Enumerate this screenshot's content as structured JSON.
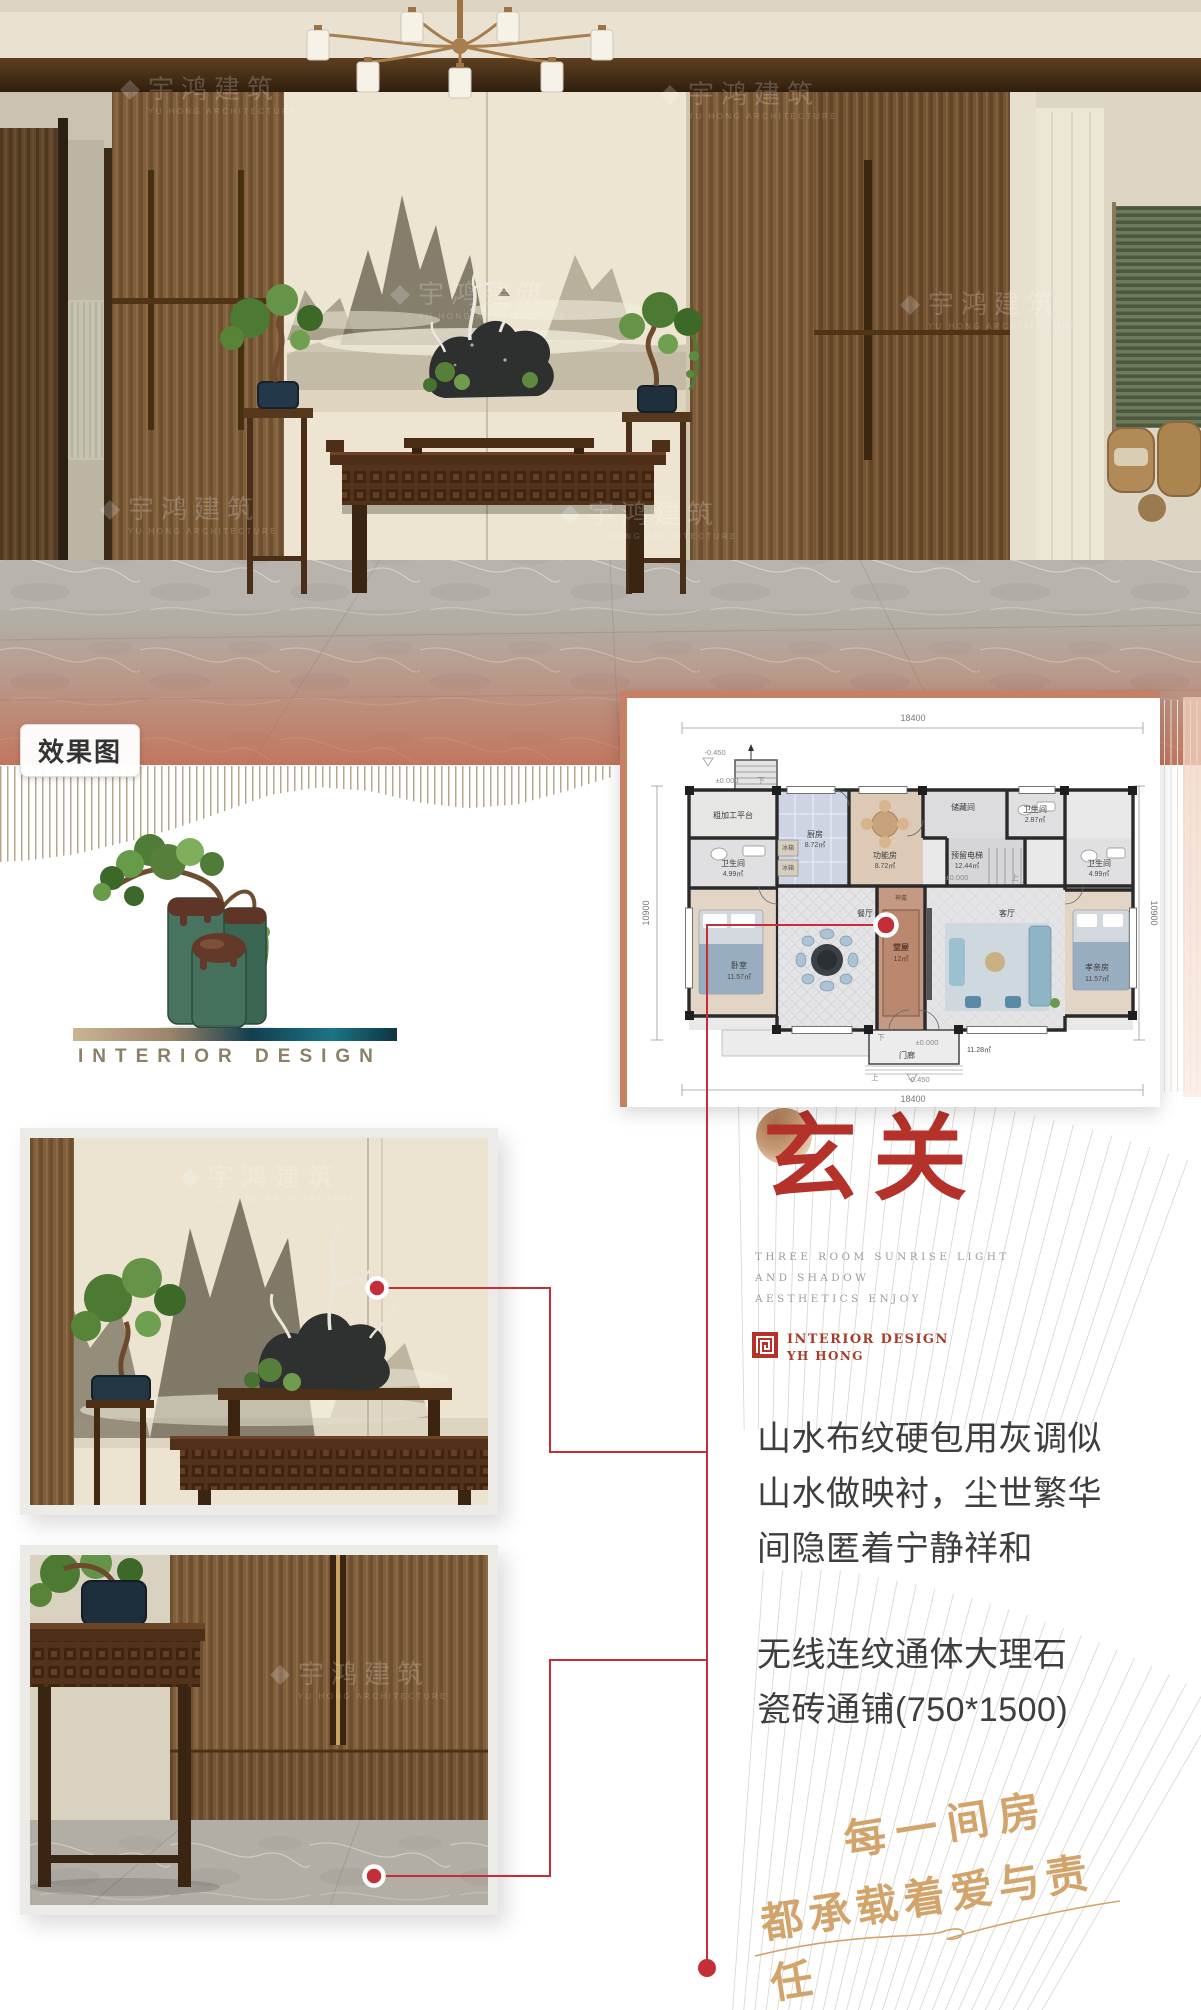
{
  "hero": {
    "tag": "效果图",
    "watermark": {
      "icon": "diamond-logo",
      "cn": "宇鸿建筑",
      "en": "YU HONG ARCHITECTURE"
    }
  },
  "brand_block": {
    "caption": "INTERIOR DESIGN"
  },
  "floor_plan": {
    "dims": {
      "top": "18400",
      "bottom": "18400",
      "left": "10900",
      "right": "10900"
    },
    "levels": {
      "top": "-0.450",
      "platform": "±0.000",
      "hall": "±0.000",
      "porch": "±0.000",
      "bottom": "-0.450"
    },
    "arrows": {
      "down1": "下",
      "down2": "下",
      "up1": "上",
      "up2": "上"
    },
    "rooms": {
      "platform": {
        "name": "粗加工平台",
        "area": ""
      },
      "kitchen": {
        "name": "厨房",
        "area": "8.72㎡"
      },
      "fridge1": {
        "name": "冰箱",
        "area": ""
      },
      "fridge2": {
        "name": "冰箱",
        "area": ""
      },
      "function": {
        "name": "功能房",
        "area": "8.72㎡"
      },
      "storage": {
        "name": "储藏间",
        "area": ""
      },
      "elevator": {
        "name": "预留电梯",
        "area": "12.44㎡"
      },
      "bath_top_right": {
        "name": "卫生间",
        "area": "2.87㎡"
      },
      "bath_left": {
        "name": "卫生间",
        "area": "4.99㎡"
      },
      "bath_right": {
        "name": "卫生间",
        "area": "4.99㎡"
      },
      "bedroom_left": {
        "name": "卧室",
        "area": "11.57㎡"
      },
      "dining": {
        "name": "餐厅",
        "area": ""
      },
      "shrine": {
        "name": "神龛",
        "area": ""
      },
      "hall": {
        "name": "堂屋",
        "area": "12㎡"
      },
      "living": {
        "name": "客厅",
        "area": ""
      },
      "bedroom_right": {
        "name": "孝亲房",
        "area": "11.57㎡"
      },
      "porch": {
        "name": "门廊",
        "area": "11.28㎡"
      }
    }
  },
  "section": {
    "title": "玄关",
    "subtitle_lines": {
      "l1": "THREE ROOM SUNRISE LIGHT",
      "l2": "AND SHADOW",
      "l3": "AESTHETICS ENJOY"
    },
    "brand": {
      "l1": "INTERIOR DESIGN",
      "l2": "YH HONG"
    }
  },
  "descriptions": {
    "p1": "山水布纹硬包用灰调似山水做映衬，尘世繁华间隐匿着宁静祥和",
    "p2": "无线连纹通体大理石瓷砖通铺(750*1500)"
  },
  "slogan": {
    "l1": "每一间房",
    "l2": "都承载着爱与责任"
  },
  "colors": {
    "accent_red": "#c22f38",
    "title_red": "#b5322a",
    "gold": "#d2a46b",
    "plan_frame": "#c97f63"
  }
}
